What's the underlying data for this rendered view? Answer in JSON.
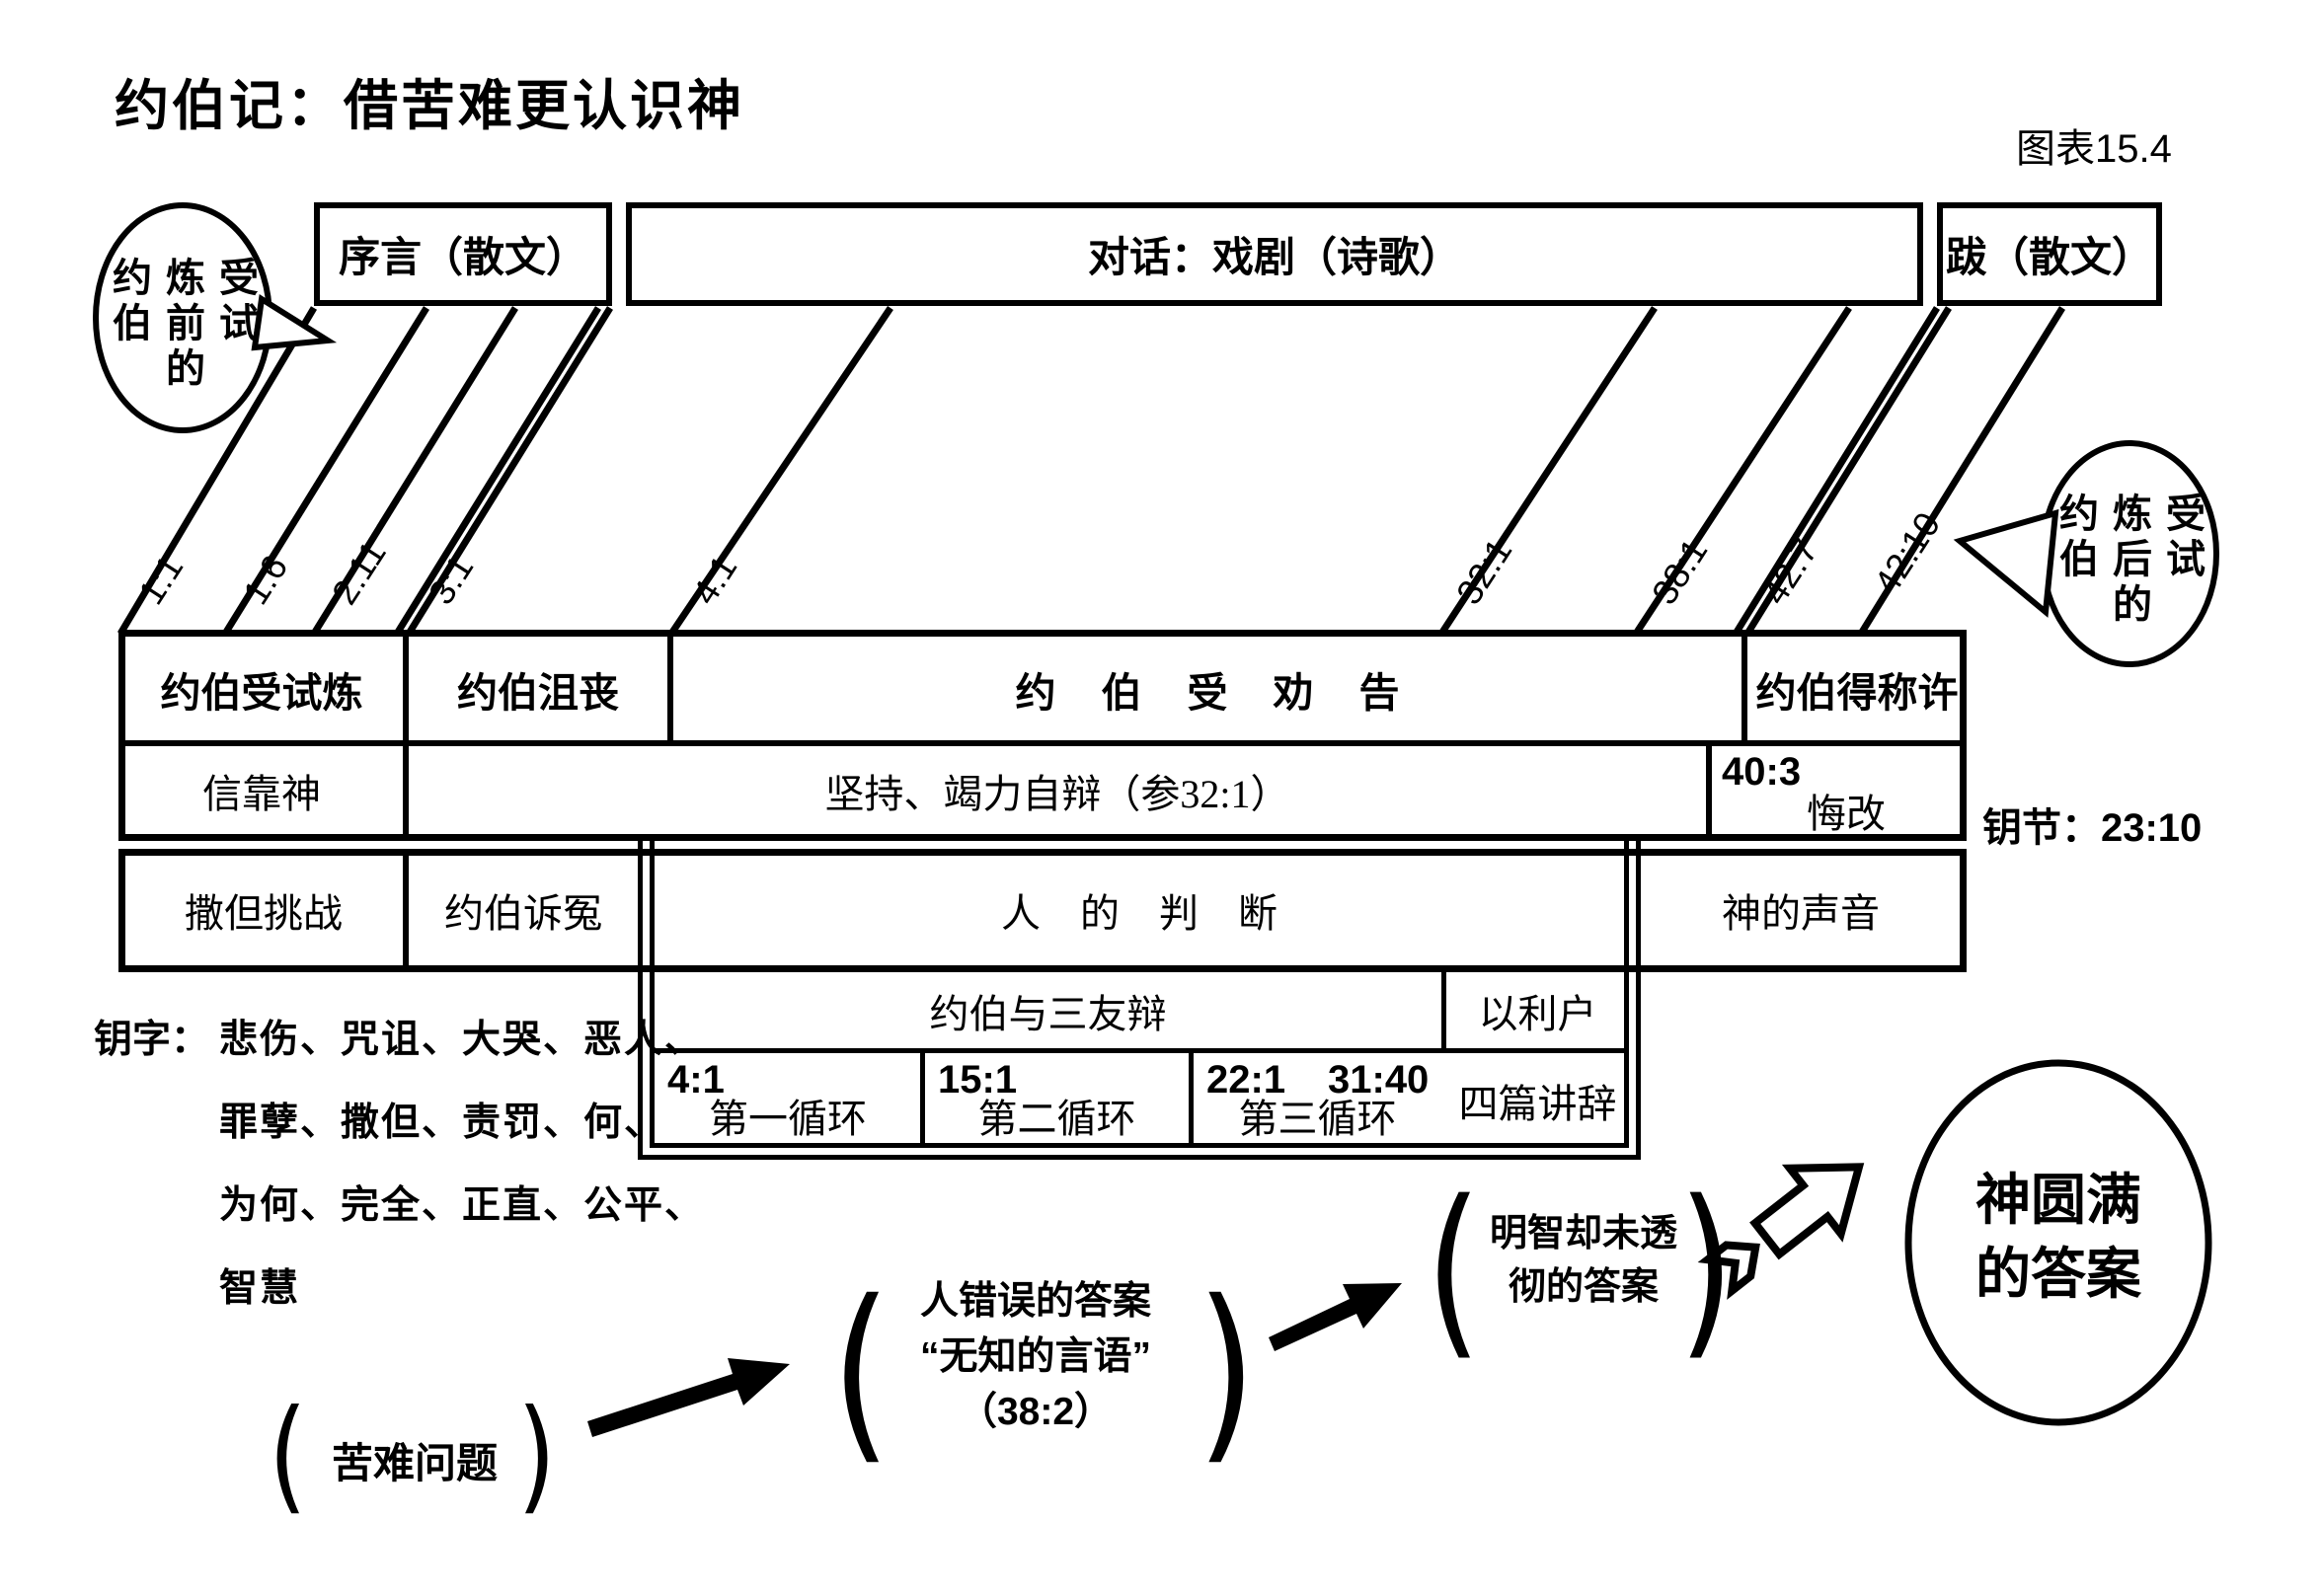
{
  "title": "约伯记：借苦难更认识神",
  "figure_label": "图表15.4",
  "headers": {
    "prologue": "序言（散文）",
    "dialogue": "对话：戏剧（诗歌）",
    "epilogue": "跋（散文）"
  },
  "bubble_left": {
    "cells": [
      "约",
      "炼",
      "受",
      "伯",
      "前",
      "试",
      "",
      "的",
      ""
    ]
  },
  "bubble_right": {
    "cells": [
      "约",
      "炼",
      "受",
      "伯",
      "后",
      "试",
      "",
      "的",
      ""
    ]
  },
  "refs": {
    "r1": "1:1",
    "r2": "1:6",
    "r3": "2:11",
    "r4": "3:1",
    "r5": "4:1",
    "r6": "32:1",
    "r7": "38:1",
    "r8": "42:7",
    "r9": "42:10"
  },
  "table": {
    "r1c1": "约伯受试炼",
    "r1c2": "约伯沮丧",
    "r1c3": "约伯受劝告",
    "r1c4": "约伯得称许",
    "r2c1": "信靠神",
    "r2c2": "坚持、竭力自辩（参32:1）",
    "r2ref": "40:3",
    "r2c3": "悔改",
    "r3c1": "撒但挑战",
    "r3c2": "约伯诉冤",
    "r3c3": "人的判断",
    "r3c4": "神的声音",
    "r4c1": "约伯与三友辩",
    "r4c2": "以利户",
    "r5c1ref": "4:1",
    "r5c1": "第一循环",
    "r5c2ref": "15:1",
    "r5c2": "第二循环",
    "r5c3ref": "22:1",
    "r5c3ref2": "31:40",
    "r5c3": "第三循环",
    "r5c4": "四篇讲辞"
  },
  "key_verse": "钥节：23:10",
  "key_words_label": "钥字：",
  "key_words_lines": [
    "悲伤、咒诅、大哭、恶人、",
    "罪孽、撒但、责罚、何、",
    "为何、完全、正直、公平、",
    "智慧"
  ],
  "flow": {
    "step1": "苦难问题",
    "step2a": "人错误的答案",
    "step2b": "“无知的言语”",
    "step2c": "（38:2）",
    "step3a": "明智却未透",
    "step3b": "彻的答案",
    "resulta": "神圆满",
    "resultb": "的答案",
    "paren_open": "(",
    "paren_close": ")"
  }
}
